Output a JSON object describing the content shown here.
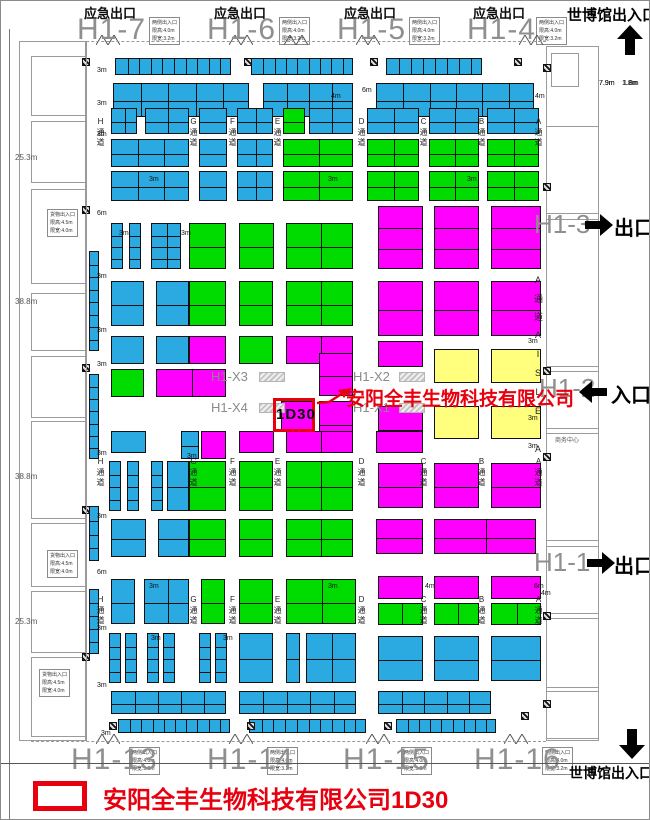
{
  "colors": {
    "b": "#2ba9e1",
    "g": "#00dc00",
    "m": "#ff00ff",
    "y": "#ffff7d",
    "highlight_red": "#e8000f",
    "hall_gray": "#8f8f8f"
  },
  "top": {
    "emergency_exit": "应急出口",
    "halls": [
      "H1-7",
      "H1-6",
      "H1-5",
      "H1-4"
    ],
    "expo_gate": "世博馆出入口"
  },
  "bottom": {
    "halls": [
      "H1-13",
      "H1-14",
      "H1-15",
      "H1-16"
    ],
    "expo_gate": "世博馆出入口"
  },
  "right": {
    "hall_h13": "H1-3",
    "hall_h12": "H1-2",
    "hall_h11": "H1-1",
    "exit_label": "出口",
    "entrance_label": "入口",
    "aisle_vertical": "A通道AISLE A",
    "business_center": "商务中心",
    "dim1": "7.9m",
    "dim2": "1.8m"
  },
  "left": {
    "measurements": [
      "25.3m",
      "38.8m",
      "38.8m",
      "25.3m"
    ]
  },
  "center": {
    "x_labels": [
      "H1-X3",
      "H1-X2",
      "H1-X4",
      "H1-X1"
    ],
    "booth_id": "1D30",
    "company": "安阳全丰生物科技有限公司"
  },
  "legend": {
    "text": "安阳全丰生物科技有限公司1D30"
  },
  "info_side_lines": [
    "两侧出入口",
    "限高:4.0m",
    "限宽:3.2m"
  ],
  "info_cargo_lines": [
    "货物出入口",
    "限高:4.5m",
    "限宽:4.0m"
  ],
  "info_boxes": [
    [
      148,
      16,
      "side"
    ],
    [
      278,
      16,
      "side"
    ],
    [
      408,
      16,
      "side"
    ],
    [
      535,
      16,
      "side"
    ],
    [
      128,
      746,
      "side"
    ],
    [
      266,
      746,
      "side"
    ],
    [
      400,
      746,
      "side"
    ],
    [
      541,
      746,
      "side"
    ],
    [
      46,
      208,
      "cargo"
    ],
    [
      46,
      549,
      "cargo"
    ],
    [
      38,
      668,
      "cargo"
    ]
  ],
  "aisle": {
    "letters": [
      "H",
      "G",
      "F",
      "E",
      "D",
      "C",
      "B",
      "A"
    ],
    "word": "通道",
    "xs": [
      95,
      188,
      227,
      272,
      356,
      418,
      476,
      533
    ],
    "band_ys": [
      116,
      456,
      594
    ]
  },
  "blocks": [
    [
      114,
      57,
      116,
      17,
      "b",
      10,
      1
    ],
    [
      250,
      57,
      102,
      17,
      "b",
      9,
      1
    ],
    [
      385,
      57,
      96,
      17,
      "b",
      8,
      1
    ],
    [
      112,
      82,
      136,
      34,
      "b",
      5,
      2
    ],
    [
      262,
      82,
      90,
      34,
      "b",
      4,
      2
    ],
    [
      375,
      82,
      158,
      34,
      "b",
      6,
      2
    ],
    [
      110,
      107,
      26,
      26,
      "b",
      2,
      2
    ],
    [
      144,
      107,
      44,
      26,
      "b",
      2,
      2
    ],
    [
      198,
      107,
      28,
      26,
      "b",
      1,
      2
    ],
    [
      236,
      107,
      36,
      26,
      "b",
      2,
      2
    ],
    [
      282,
      107,
      22,
      26,
      "g",
      1,
      2
    ],
    [
      308,
      107,
      44,
      26,
      "b",
      2,
      2
    ],
    [
      366,
      107,
      52,
      26,
      "b",
      2,
      2
    ],
    [
      428,
      107,
      50,
      26,
      "b",
      2,
      2
    ],
    [
      486,
      107,
      52,
      26,
      "b",
      2,
      2
    ],
    [
      110,
      138,
      78,
      28,
      "b",
      3,
      2
    ],
    [
      198,
      138,
      28,
      28,
      "b",
      1,
      2
    ],
    [
      236,
      138,
      36,
      28,
      "b",
      2,
      2
    ],
    [
      282,
      138,
      70,
      28,
      "g",
      2,
      2
    ],
    [
      366,
      138,
      52,
      28,
      "g",
      2,
      2
    ],
    [
      428,
      138,
      50,
      28,
      "g",
      2,
      2
    ],
    [
      486,
      138,
      52,
      28,
      "g",
      2,
      2
    ],
    [
      110,
      170,
      78,
      30,
      "b",
      3,
      2
    ],
    [
      198,
      170,
      28,
      30,
      "b",
      1,
      2
    ],
    [
      236,
      170,
      36,
      30,
      "b",
      2,
      2
    ],
    [
      282,
      170,
      70,
      30,
      "g",
      2,
      2
    ],
    [
      366,
      170,
      52,
      30,
      "g",
      2,
      2
    ],
    [
      428,
      170,
      50,
      30,
      "g",
      2,
      2
    ],
    [
      486,
      170,
      52,
      30,
      "g",
      2,
      2
    ],
    [
      110,
      222,
      12,
      46,
      "b",
      1,
      4
    ],
    [
      128,
      222,
      12,
      46,
      "b",
      1,
      4
    ],
    [
      150,
      222,
      30,
      46,
      "b",
      2,
      4
    ],
    [
      188,
      222,
      37,
      46,
      "g",
      1,
      2
    ],
    [
      238,
      222,
      35,
      46,
      "g",
      1,
      2
    ],
    [
      285,
      222,
      67,
      46,
      "g",
      2,
      2
    ],
    [
      377,
      205,
      45,
      63,
      "m",
      1,
      3
    ],
    [
      433,
      205,
      45,
      63,
      "m",
      1,
      3
    ],
    [
      490,
      205,
      50,
      63,
      "m",
      1,
      3
    ],
    [
      110,
      280,
      33,
      45,
      "b",
      1,
      2
    ],
    [
      155,
      280,
      33,
      45,
      "b",
      1,
      2
    ],
    [
      188,
      280,
      37,
      45,
      "g",
      1,
      2
    ],
    [
      238,
      280,
      34,
      45,
      "g",
      1,
      2
    ],
    [
      285,
      280,
      67,
      45,
      "g",
      2,
      2
    ],
    [
      377,
      280,
      45,
      55,
      "m",
      1,
      2
    ],
    [
      433,
      280,
      45,
      55,
      "m",
      1,
      2
    ],
    [
      490,
      280,
      50,
      55,
      "m",
      1,
      2
    ],
    [
      110,
      335,
      33,
      28,
      "b",
      1,
      1
    ],
    [
      155,
      335,
      33,
      28,
      "b",
      1,
      1
    ],
    [
      188,
      335,
      37,
      28,
      "m",
      1,
      1
    ],
    [
      238,
      335,
      34,
      28,
      "g",
      1,
      1
    ],
    [
      285,
      335,
      67,
      28,
      "m",
      2,
      1
    ],
    [
      377,
      340,
      45,
      26,
      "m",
      1,
      1
    ],
    [
      433,
      348,
      45,
      34,
      "y",
      1,
      1
    ],
    [
      490,
      348,
      50,
      34,
      "y",
      1,
      1
    ],
    [
      110,
      368,
      33,
      28,
      "g",
      1,
      1
    ],
    [
      155,
      368,
      70,
      28,
      "m",
      2,
      1
    ],
    [
      318,
      352,
      34,
      43,
      "m",
      1,
      2
    ],
    [
      280,
      400,
      33,
      30,
      "m",
      1,
      1
    ],
    [
      318,
      400,
      34,
      45,
      "m",
      1,
      2
    ],
    [
      180,
      430,
      18,
      28,
      "b",
      1,
      2
    ],
    [
      200,
      430,
      25,
      28,
      "m",
      1,
      1
    ],
    [
      377,
      405,
      45,
      25,
      "m",
      1,
      1
    ],
    [
      433,
      405,
      45,
      33,
      "y",
      1,
      1
    ],
    [
      490,
      405,
      50,
      33,
      "y",
      1,
      1
    ],
    [
      110,
      430,
      35,
      22,
      "b",
      1,
      1
    ],
    [
      238,
      430,
      35,
      22,
      "m",
      1,
      1
    ],
    [
      285,
      430,
      67,
      22,
      "m",
      2,
      1
    ],
    [
      375,
      430,
      47,
      22,
      "m",
      1,
      1
    ],
    [
      108,
      460,
      12,
      50,
      "b",
      1,
      4
    ],
    [
      126,
      460,
      12,
      50,
      "b",
      1,
      4
    ],
    [
      150,
      460,
      12,
      50,
      "b",
      1,
      4
    ],
    [
      166,
      460,
      22,
      50,
      "b",
      1,
      2
    ],
    [
      188,
      460,
      37,
      50,
      "g",
      1,
      2
    ],
    [
      238,
      460,
      34,
      50,
      "g",
      1,
      2
    ],
    [
      285,
      460,
      67,
      50,
      "g",
      2,
      2
    ],
    [
      377,
      462,
      45,
      45,
      "m",
      1,
      2
    ],
    [
      433,
      462,
      45,
      45,
      "m",
      1,
      2
    ],
    [
      490,
      462,
      50,
      45,
      "m",
      1,
      2
    ],
    [
      110,
      518,
      35,
      38,
      "b",
      1,
      2
    ],
    [
      157,
      518,
      31,
      38,
      "b",
      1,
      2
    ],
    [
      188,
      518,
      37,
      38,
      "g",
      1,
      2
    ],
    [
      238,
      518,
      34,
      38,
      "g",
      1,
      2
    ],
    [
      285,
      518,
      67,
      38,
      "g",
      2,
      2
    ],
    [
      375,
      518,
      47,
      35,
      "m",
      1,
      2
    ],
    [
      433,
      518,
      102,
      35,
      "m",
      2,
      2
    ],
    [
      110,
      578,
      24,
      45,
      "b",
      1,
      2
    ],
    [
      143,
      578,
      45,
      45,
      "b",
      2,
      2
    ],
    [
      200,
      578,
      24,
      45,
      "g",
      1,
      2
    ],
    [
      238,
      578,
      34,
      45,
      "g",
      1,
      2
    ],
    [
      285,
      578,
      70,
      45,
      "g",
      2,
      2
    ],
    [
      377,
      575,
      45,
      23,
      "m",
      1,
      1
    ],
    [
      433,
      575,
      45,
      23,
      "m",
      1,
      1
    ],
    [
      490,
      575,
      50,
      23,
      "m",
      1,
      1
    ],
    [
      377,
      602,
      45,
      22,
      "g",
      2,
      1
    ],
    [
      433,
      602,
      45,
      22,
      "g",
      2,
      1
    ],
    [
      490,
      602,
      50,
      22,
      "g",
      2,
      1
    ],
    [
      108,
      632,
      12,
      50,
      "b",
      1,
      4
    ],
    [
      124,
      632,
      12,
      50,
      "b",
      1,
      4
    ],
    [
      146,
      632,
      12,
      50,
      "b",
      1,
      4
    ],
    [
      162,
      632,
      12,
      50,
      "b",
      1,
      4
    ],
    [
      198,
      632,
      12,
      50,
      "b",
      1,
      4
    ],
    [
      214,
      632,
      12,
      50,
      "b",
      1,
      4
    ],
    [
      238,
      632,
      34,
      50,
      "b",
      1,
      2
    ],
    [
      285,
      632,
      14,
      50,
      "b",
      1,
      2
    ],
    [
      305,
      632,
      50,
      50,
      "b",
      2,
      2
    ],
    [
      377,
      635,
      45,
      45,
      "b",
      1,
      2
    ],
    [
      433,
      635,
      45,
      45,
      "b",
      1,
      2
    ],
    [
      490,
      635,
      50,
      45,
      "b",
      1,
      2
    ],
    [
      110,
      690,
      115,
      23,
      "b",
      5,
      2
    ],
    [
      238,
      690,
      117,
      23,
      "b",
      5,
      2
    ],
    [
      377,
      690,
      113,
      23,
      "b",
      5,
      2
    ],
    [
      117,
      718,
      112,
      14,
      "b",
      10,
      1
    ],
    [
      248,
      718,
      117,
      14,
      "b",
      10,
      1
    ],
    [
      395,
      718,
      100,
      14,
      "b",
      9,
      1
    ],
    [
      88,
      250,
      10,
      100,
      "b",
      1,
      8
    ],
    [
      88,
      373,
      10,
      85,
      "b",
      1,
      7
    ],
    [
      88,
      505,
      10,
      55,
      "b",
      1,
      4
    ],
    [
      88,
      588,
      10,
      65,
      "b",
      1,
      5
    ]
  ],
  "dims": [
    [
      96,
      66,
      "3m"
    ],
    [
      330,
      92,
      "4m"
    ],
    [
      361,
      86,
      "6m"
    ],
    [
      534,
      92,
      "4m"
    ],
    [
      96,
      99,
      "3m"
    ],
    [
      96,
      130,
      "3m"
    ],
    [
      148,
      175,
      "3m"
    ],
    [
      327,
      175,
      "3m"
    ],
    [
      466,
      175,
      "3m"
    ],
    [
      96,
      209,
      "6m"
    ],
    [
      118,
      229,
      "3m"
    ],
    [
      180,
      229,
      "3m"
    ],
    [
      96,
      272,
      "3m"
    ],
    [
      96,
      326,
      "3m"
    ],
    [
      96,
      360,
      "3m"
    ],
    [
      527,
      337,
      "3m"
    ],
    [
      527,
      414,
      "3m"
    ],
    [
      96,
      449,
      "3m"
    ],
    [
      186,
      452,
      "3m"
    ],
    [
      96,
      512,
      "3m"
    ],
    [
      96,
      568,
      "6m"
    ],
    [
      148,
      582,
      "3m"
    ],
    [
      327,
      582,
      "3m"
    ],
    [
      424,
      582,
      "4m"
    ],
    [
      533,
      582,
      "6m"
    ],
    [
      96,
      624,
      "3m"
    ],
    [
      150,
      634,
      "3m"
    ],
    [
      222,
      634,
      "3m"
    ],
    [
      96,
      681,
      "3m"
    ],
    [
      100,
      729,
      "3m"
    ],
    [
      540,
      589,
      "4m"
    ],
    [
      598,
      79,
      "7.9m"
    ],
    [
      621,
      79,
      "1.8m"
    ],
    [
      527,
      442,
      "3m"
    ]
  ],
  "pillars": [
    [
      81,
      57
    ],
    [
      243,
      57
    ],
    [
      369,
      57
    ],
    [
      513,
      57
    ],
    [
      81,
      205
    ],
    [
      81,
      363
    ],
    [
      81,
      505
    ],
    [
      81,
      652
    ],
    [
      542,
      63
    ],
    [
      542,
      182
    ],
    [
      542,
      366
    ],
    [
      542,
      452
    ],
    [
      542,
      611
    ],
    [
      542,
      699
    ],
    [
      108,
      721
    ],
    [
      246,
      721
    ],
    [
      383,
      721
    ],
    [
      520,
      711
    ]
  ],
  "doors": {
    "top_y": 34,
    "bottom_y": 733,
    "top_xs": [
      95,
      228,
      283,
      355,
      518
    ],
    "bottom_xs": [
      95,
      228,
      365,
      503
    ]
  },
  "rooms": [
    [
      18,
      40,
      67,
      700
    ],
    [
      30,
      55,
      55,
      60
    ],
    [
      30,
      120,
      55,
      62
    ],
    [
      30,
      188,
      55,
      95
    ],
    [
      30,
      292,
      55,
      58
    ],
    [
      30,
      355,
      55,
      62
    ],
    [
      30,
      420,
      55,
      98
    ],
    [
      30,
      522,
      55,
      64
    ],
    [
      30,
      590,
      55,
      62
    ],
    [
      30,
      656,
      55,
      80
    ],
    [
      545,
      45,
      53,
      695
    ],
    [
      550,
      52,
      28,
      34
    ],
    [
      545,
      125,
      53,
      88
    ],
    [
      545,
      218,
      53,
      148
    ],
    [
      545,
      370,
      53,
      58
    ],
    [
      545,
      432,
      53,
      108
    ],
    [
      545,
      545,
      53,
      68
    ],
    [
      545,
      617,
      53,
      70
    ],
    [
      545,
      690,
      53,
      48
    ]
  ]
}
